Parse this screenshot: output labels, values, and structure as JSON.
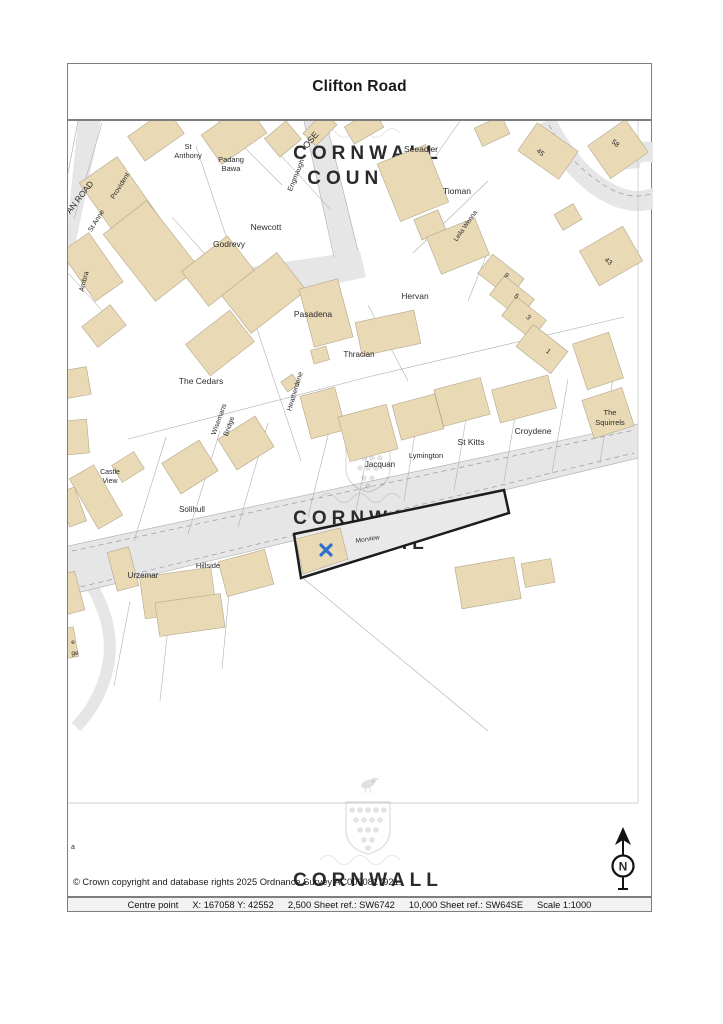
{
  "title": "Clifton Road",
  "watermark": {
    "line1": "CORNWALL",
    "line2": "COUNCIL"
  },
  "north": {
    "label": "N"
  },
  "copyright": "© Crown copyright and database rights 2025 Ordnance Survey AC0000817921.",
  "footer": {
    "label": "Centre point",
    "coords": "X: 167058 Y: 42552",
    "sheet2500": "2,500 Sheet ref.: SW6742",
    "sheet10000": "10,000 Sheet ref.: SW64SE",
    "scale": "Scale 1:1000"
  },
  "map": {
    "plot_marker_color": "#2e6fd0",
    "building_fill": "#e9d9b4",
    "road_fill": "#e6e6e7",
    "labels": [
      {
        "t": "AN ROAD",
        "x": 14,
        "y": 78,
        "r": -52,
        "s": 8.5
      },
      {
        "t": "Provident",
        "x": 54,
        "y": 66,
        "r": -58,
        "s": 7
      },
      {
        "t": "St Anne",
        "x": 30,
        "y": 101,
        "r": -58,
        "s": 7
      },
      {
        "t": "St",
        "x": 120,
        "y": 28,
        "r": 0,
        "s": 7.5
      },
      {
        "t": "Anthony",
        "x": 120,
        "y": 37,
        "r": 0,
        "s": 7.5
      },
      {
        "t": "Padang",
        "x": 163,
        "y": 41,
        "r": 0,
        "s": 7.5
      },
      {
        "t": "Bawa",
        "x": 163,
        "y": 50,
        "r": 0,
        "s": 7.5
      },
      {
        "t": "OSE",
        "x": 245,
        "y": 21,
        "r": -50,
        "s": 9
      },
      {
        "t": "Engmaugh",
        "x": 230,
        "y": 55,
        "r": -68,
        "s": 7
      },
      {
        "t": "Newcott",
        "x": 198,
        "y": 109,
        "r": 0,
        "s": 8.5
      },
      {
        "t": "Seeadler",
        "x": 353,
        "y": 31,
        "r": 0,
        "s": 8.5
      },
      {
        "t": "Tioman",
        "x": 389,
        "y": 73,
        "r": 0,
        "s": 8.5
      },
      {
        "t": "Leila Wenna",
        "x": 399,
        "y": 106,
        "r": -55,
        "s": 6.5
      },
      {
        "t": "Godrevy",
        "x": 161,
        "y": 126,
        "r": 0,
        "s": 8.5
      },
      {
        "t": "45",
        "x": 471,
        "y": 33,
        "r": 40,
        "s": 7
      },
      {
        "t": "58",
        "x": 546,
        "y": 24,
        "r": 40,
        "s": 7
      },
      {
        "t": "43",
        "x": 539,
        "y": 142,
        "r": 40,
        "s": 7
      },
      {
        "t": "Ambra",
        "x": 18,
        "y": 161,
        "r": -75,
        "s": 7
      },
      {
        "t": "Pasadena",
        "x": 245,
        "y": 196,
        "r": 0,
        "s": 8.5
      },
      {
        "t": "Hervan",
        "x": 347,
        "y": 178,
        "r": 0,
        "s": 8.5
      },
      {
        "t": "Thracian",
        "x": 291,
        "y": 236,
        "r": 0,
        "s": 8
      },
      {
        "t": "The Cedars",
        "x": 133,
        "y": 263,
        "r": 0,
        "s": 8.5
      },
      {
        "t": "Heatherdene",
        "x": 229,
        "y": 271,
        "r": -73,
        "s": 7
      },
      {
        "t": "Wisemans",
        "x": 153,
        "y": 299,
        "r": -70,
        "s": 7
      },
      {
        "t": "Bridge",
        "x": 163,
        "y": 306,
        "r": -70,
        "s": 7
      },
      {
        "t": "9",
        "x": 437,
        "y": 156,
        "r": 40,
        "s": 7
      },
      {
        "t": "5",
        "x": 447,
        "y": 177,
        "r": 40,
        "s": 7
      },
      {
        "t": "3",
        "x": 459,
        "y": 198,
        "r": 40,
        "s": 7
      },
      {
        "t": "1",
        "x": 479,
        "y": 232,
        "r": 40,
        "s": 7
      },
      {
        "t": "The",
        "x": 542,
        "y": 294,
        "r": 0,
        "s": 7.5
      },
      {
        "t": "Squirrels",
        "x": 542,
        "y": 304,
        "r": 0,
        "s": 7.5
      },
      {
        "t": "Croydene",
        "x": 465,
        "y": 313,
        "r": 0,
        "s": 8.5
      },
      {
        "t": "St Kitts",
        "x": 403,
        "y": 324,
        "r": 0,
        "s": 8.5
      },
      {
        "t": "Lymington",
        "x": 358,
        "y": 337,
        "r": 0,
        "s": 7.5
      },
      {
        "t": "Jacquan",
        "x": 312,
        "y": 346,
        "r": 0,
        "s": 8
      },
      {
        "t": "Castle",
        "x": 42,
        "y": 353,
        "r": 0,
        "s": 7
      },
      {
        "t": "View",
        "x": 42,
        "y": 362,
        "r": 0,
        "s": 7
      },
      {
        "t": "Solihull",
        "x": 124,
        "y": 391,
        "r": 0,
        "s": 8
      },
      {
        "t": "Urzemar",
        "x": 75,
        "y": 457,
        "r": 0,
        "s": 8
      },
      {
        "t": "Hillside",
        "x": 140,
        "y": 447,
        "r": 0,
        "s": 7.5
      },
      {
        "t": "Morview",
        "x": 300,
        "y": 420,
        "r": -9,
        "s": 6.5,
        "c": "#4a4a4a"
      },
      {
        "t": "e",
        "x": 5,
        "y": 523,
        "r": 0,
        "s": 6.5
      },
      {
        "t": "ge",
        "x": 7,
        "y": 534,
        "r": 0,
        "s": 6.5
      },
      {
        "t": "a",
        "x": 5,
        "y": 728,
        "r": 0,
        "s": 7
      }
    ]
  }
}
